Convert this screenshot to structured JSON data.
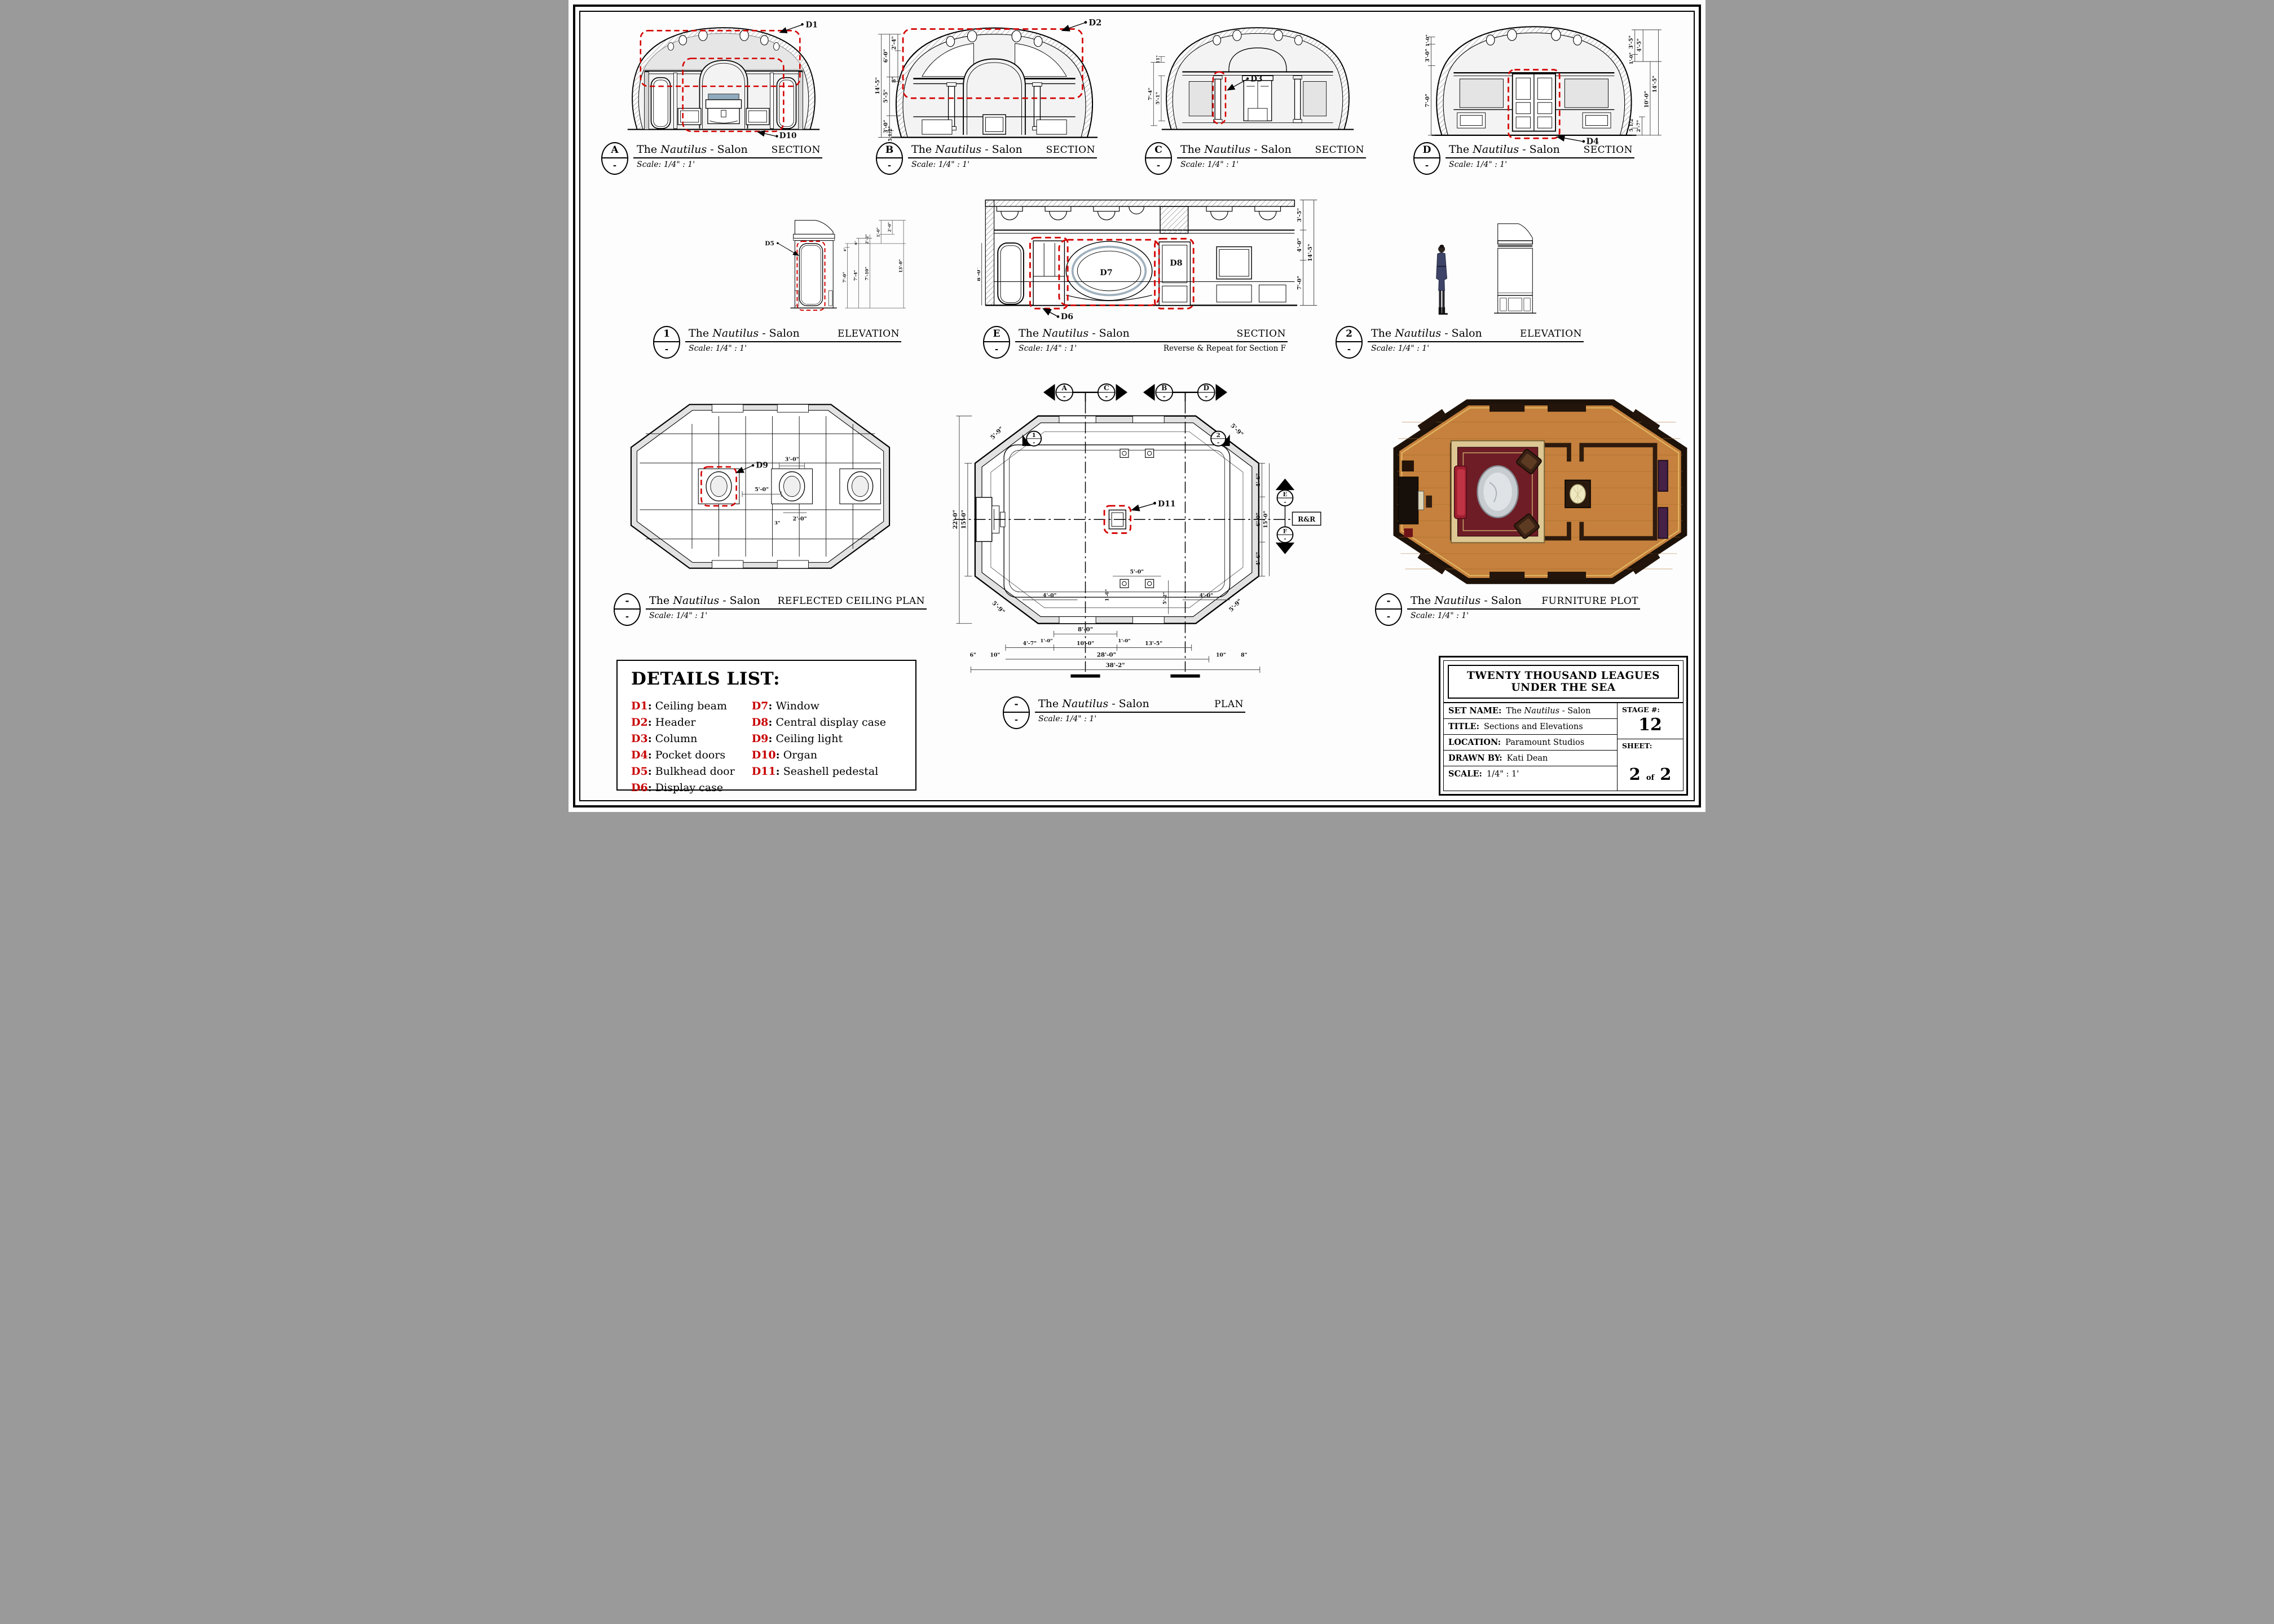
{
  "name": {
    "pre": "The",
    "it": "Nautilus",
    "post": "- Salon"
  },
  "scale_text": "Scale:  1/4\" : 1'",
  "punct": {
    "colon": ":"
  },
  "views": {
    "a": {
      "letter": "A",
      "sub": "-",
      "type": "SECTION"
    },
    "b": {
      "letter": "B",
      "sub": "-",
      "type": "SECTION"
    },
    "c": {
      "letter": "C",
      "sub": "-",
      "type": "SECTION"
    },
    "d": {
      "letter": "D",
      "sub": "-",
      "type": "SECTION"
    },
    "elev1": {
      "letter": "1",
      "sub": "-",
      "type": "ELEVATION"
    },
    "e": {
      "letter": "E",
      "sub": "-",
      "type": "SECTION",
      "note": "Reverse & Repeat for Section F"
    },
    "elev2": {
      "letter": "2",
      "sub": "-",
      "type": "ELEVATION"
    },
    "rcp": {
      "letter": "-",
      "sub": "-",
      "type": "REFLECTED CEILING PLAN"
    },
    "plan": {
      "letter": "-",
      "sub": "-",
      "type": "PLAN"
    },
    "furn": {
      "letter": "-",
      "sub": "-",
      "type": "FURNITURE PLOT"
    }
  },
  "details_list": {
    "title": "DETAILS LIST:",
    "items": [
      {
        "id": "D1",
        "label": "Ceiling beam"
      },
      {
        "id": "D2",
        "label": "Header"
      },
      {
        "id": "D3",
        "label": "Column"
      },
      {
        "id": "D4",
        "label": "Pocket doors"
      },
      {
        "id": "D5",
        "label": "Bulkhead door"
      },
      {
        "id": "D6",
        "label": "Display case"
      },
      {
        "id": "D7",
        "label": "Window"
      },
      {
        "id": "D8",
        "label": "Central display case"
      },
      {
        "id": "D9",
        "label": "Ceiling light"
      },
      {
        "id": "D10",
        "label": "Organ"
      },
      {
        "id": "D11",
        "label": "Seashell pedestal"
      }
    ]
  },
  "labels": {
    "d1": "D1",
    "d2": "D2",
    "d3": "D3",
    "d4": "D4",
    "d5": "D5",
    "d6": "D6",
    "d7": "D7",
    "d8": "D8",
    "d9": "D9",
    "d10": "D10",
    "d11": "D11",
    "rr": "R&R"
  },
  "markers": {
    "a": "A",
    "c": "C",
    "b": "B",
    "d": "D",
    "e": "E",
    "f": "F",
    "n1": "1",
    "n2": "2",
    "sub": "-"
  },
  "dims": {
    "section_b": [
      "2'-4\"",
      "6'-0\"",
      "8\"",
      "14'-5\"",
      "5'-5\"",
      "3'-0\"",
      "5 1/2\""
    ],
    "section_c": [
      "11\"",
      "7'-4\"",
      "5'-1\""
    ],
    "section_d_left": [
      "1'-0\"",
      "3'-0\"",
      "7'-0\""
    ],
    "section_d_right": [
      "3'-5\"",
      "4'-5\"",
      "1'-0\"",
      "14'-5\"",
      "10'-0\"",
      "5 1/2\"",
      "2'-7\""
    ],
    "elev1": [
      "2'-0\"",
      "1'-0\"",
      "2'-2\"",
      "6\"",
      "4\"",
      "7'-0\"",
      "7'-4\"",
      "7'-10\"",
      "13'-0\""
    ],
    "section_e_left": "8'-0\"",
    "section_e_right": [
      "3'-5\"",
      "4'-0\"",
      "7'-0\"",
      "14'-5\""
    ],
    "rcp": [
      "5'-0\"",
      "3'-0\"",
      "2'-0\"",
      "3\""
    ],
    "plan_corner": "5'-9\"",
    "plan_left": [
      "22'-0\"",
      "15'-0\""
    ],
    "plan_right": [
      "4'-6\"",
      "6'-0\"",
      "4'-6\"",
      "15'-0\""
    ],
    "plan_inner": [
      "4'-0\"",
      "5'-0\"",
      "1'-0\"",
      "5'-2\"",
      "4'-0\""
    ],
    "plan_bottom": [
      "8'-0\"",
      "1'-0\"",
      "1'-0\"",
      "4'-7\"",
      "10'-0\"",
      "13'-5\"",
      "28'-0\"",
      "6\"",
      "10\"",
      "10\"",
      "8\"",
      "38'-2\""
    ]
  },
  "title_block": {
    "production": "TWENTY THOUSAND LEAGUES UNDER THE SEA",
    "set_name_label": "SET NAME:",
    "title_label": "TITLE:",
    "title": "Sections and Elevations",
    "location_label": "LOCATION:",
    "location": "Paramount Studios",
    "drawn_by_label": "DRAWN BY:",
    "drawn_by": "Kati Dean",
    "scale_label": "SCALE:",
    "scale_value": "1/4\" : 1'",
    "stage_label": "STAGE #:",
    "stage": "12",
    "sheet_label": "SHEET:",
    "sheet_num": "2",
    "sheet_of": "of",
    "sheet_total": "2"
  }
}
